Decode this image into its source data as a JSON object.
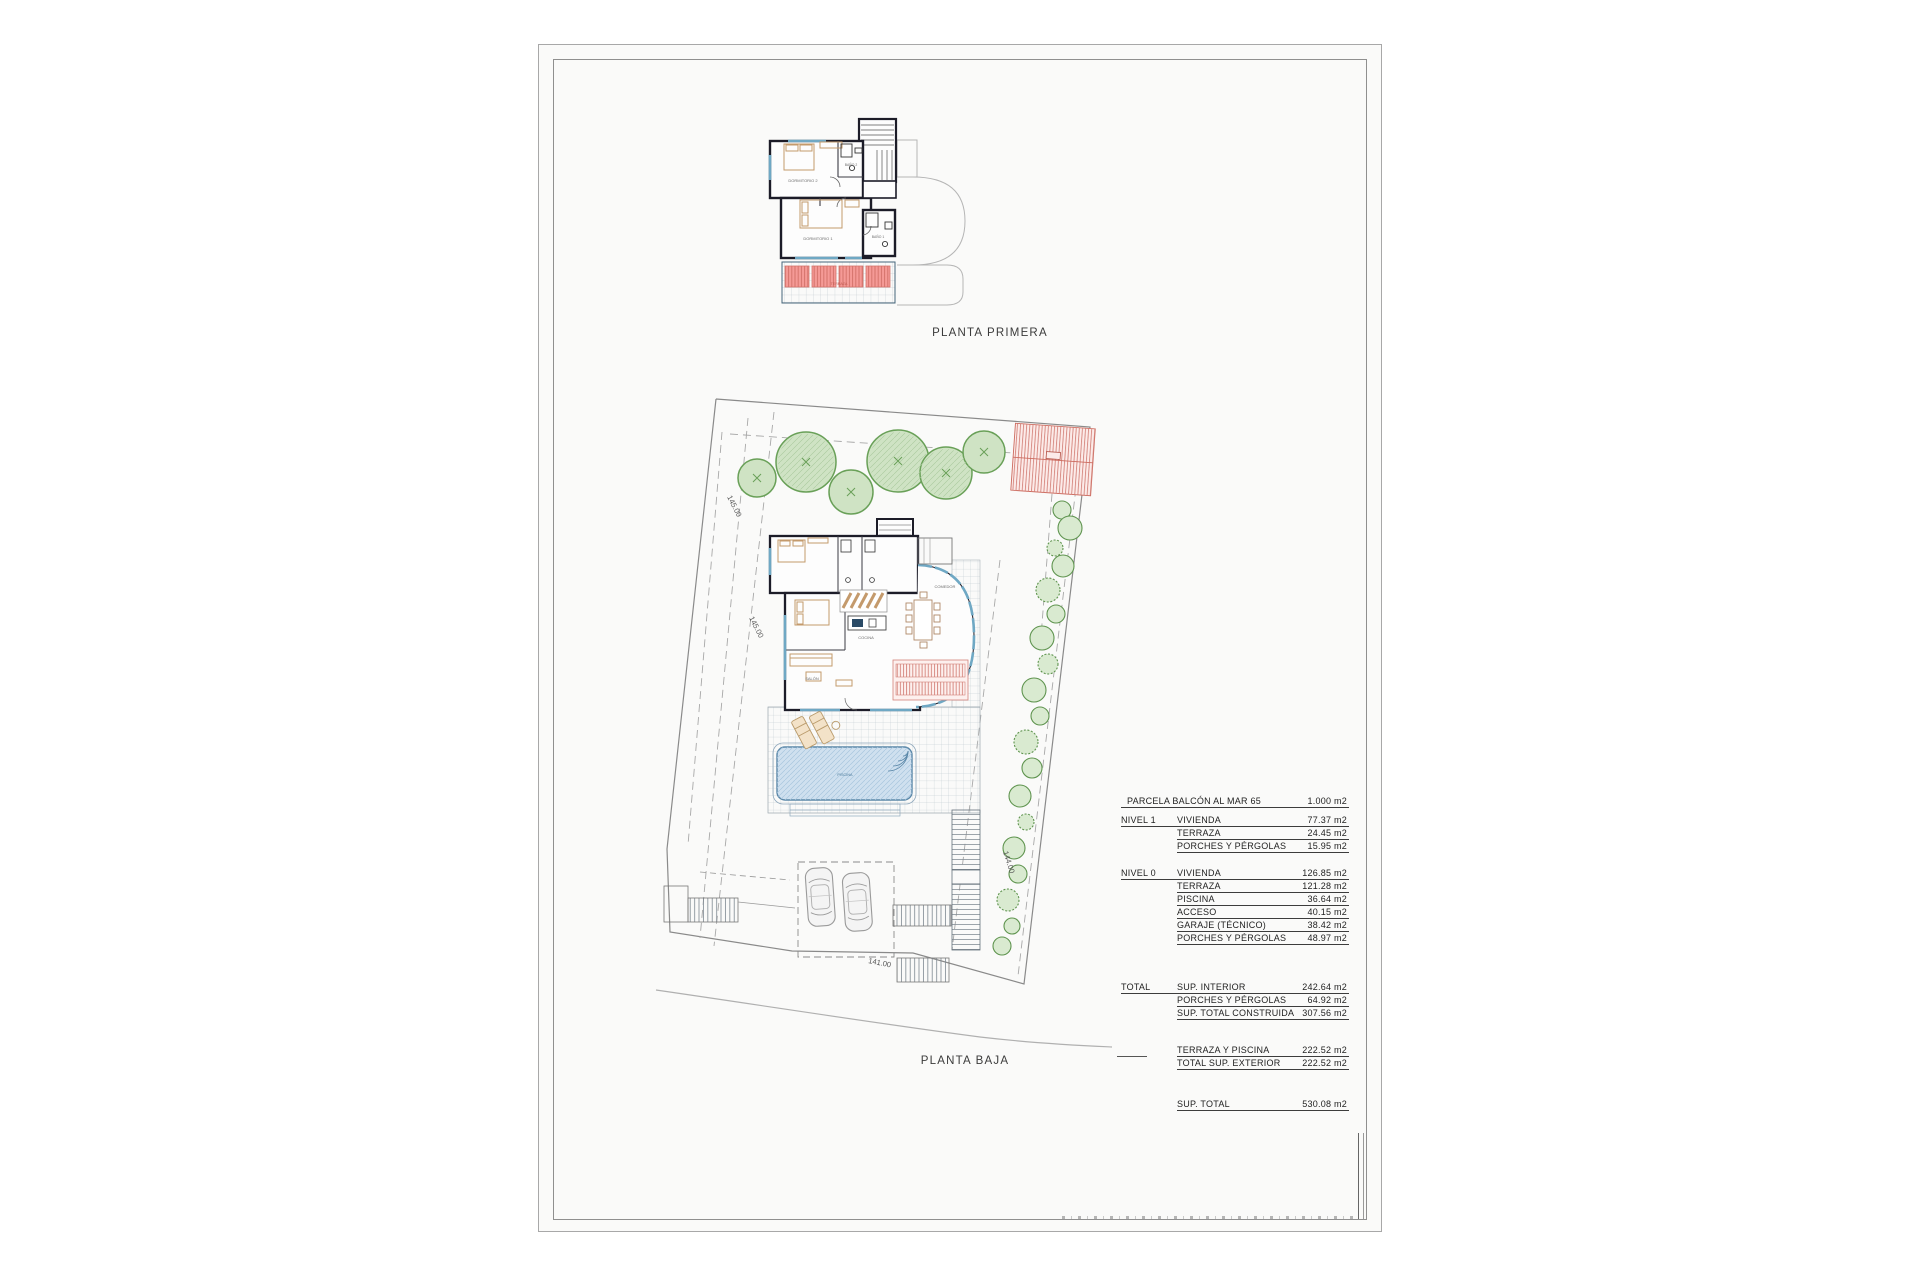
{
  "sheet": {
    "planta_primera_label": "PLANTA PRIMERA",
    "planta_baja_label": "PLANTA BAJA"
  },
  "plan_labels": {
    "dormitorio2": "DORMITORIO 2",
    "bano2": "BAÑO 2",
    "dormitorio1": "DORMITORIO 1",
    "bano1": "BAÑO 1",
    "terraza": "TERRAZA",
    "cocina": "COCINA",
    "comedor": "COMEDOR",
    "salon": "SALÓN",
    "piscina": "PISCINA"
  },
  "contour_labels": {
    "c145": "145.00",
    "c144": "144.00",
    "c141": "141.00"
  },
  "area_table": {
    "header": {
      "label": "PARCELA BALCÓN AL MAR 65",
      "value": "1.000 m2"
    },
    "sections": [
      {
        "group": "NIVEL 1",
        "rows": [
          {
            "l": "VIVIENDA",
            "v": "77.37 m2"
          },
          {
            "l": "TERRAZA",
            "v": "24.45 m2"
          },
          {
            "l": "PORCHES Y PÉRGOLAS",
            "v": "15.95 m2"
          }
        ]
      },
      {
        "group": "NIVEL 0",
        "rows": [
          {
            "l": "VIVIENDA",
            "v": "126.85 m2"
          },
          {
            "l": "TERRAZA",
            "v": "121.28 m2"
          },
          {
            "l": "PISCINA",
            "v": "36.64 m2"
          },
          {
            "l": "ACCESO",
            "v": "40.15 m2"
          },
          {
            "l": "GARAJE (TÉCNICO)",
            "v": "38.42 m2"
          },
          {
            "l": "PORCHES Y PÉRGOLAS",
            "v": "48.97 m2"
          }
        ]
      },
      {
        "group": "TOTAL",
        "rows": [
          {
            "l": "SUP. INTERIOR",
            "v": "242.64 m2"
          },
          {
            "l": "PORCHES Y PÉRGOLAS",
            "v": "64.92 m2"
          },
          {
            "l": "SUP. TOTAL CONSTRUIDA",
            "v": "307.56 m2"
          }
        ]
      },
      {
        "group": "",
        "rows": [
          {
            "l": "TERRAZA Y PISCINA",
            "v": "222.52 m2"
          },
          {
            "l": "TOTAL SUP. EXTERIOR",
            "v": "222.52 m2"
          }
        ]
      },
      {
        "group": "",
        "rows": [
          {
            "l": "SUP. TOTAL",
            "v": "530.08 m2"
          }
        ]
      }
    ]
  },
  "colors": {
    "wall": "#1c1c28",
    "glazing": "#6fa8c4",
    "tree_stroke": "#69a058",
    "tree_fill": "#cfe3c4",
    "pergola_red": "#d4736b",
    "pergola_fill": "#f7b9b4",
    "pool_stroke": "#5a87a8",
    "pool_fill": "#cfe0ef",
    "boundary_gray": "#8a8a8a"
  }
}
